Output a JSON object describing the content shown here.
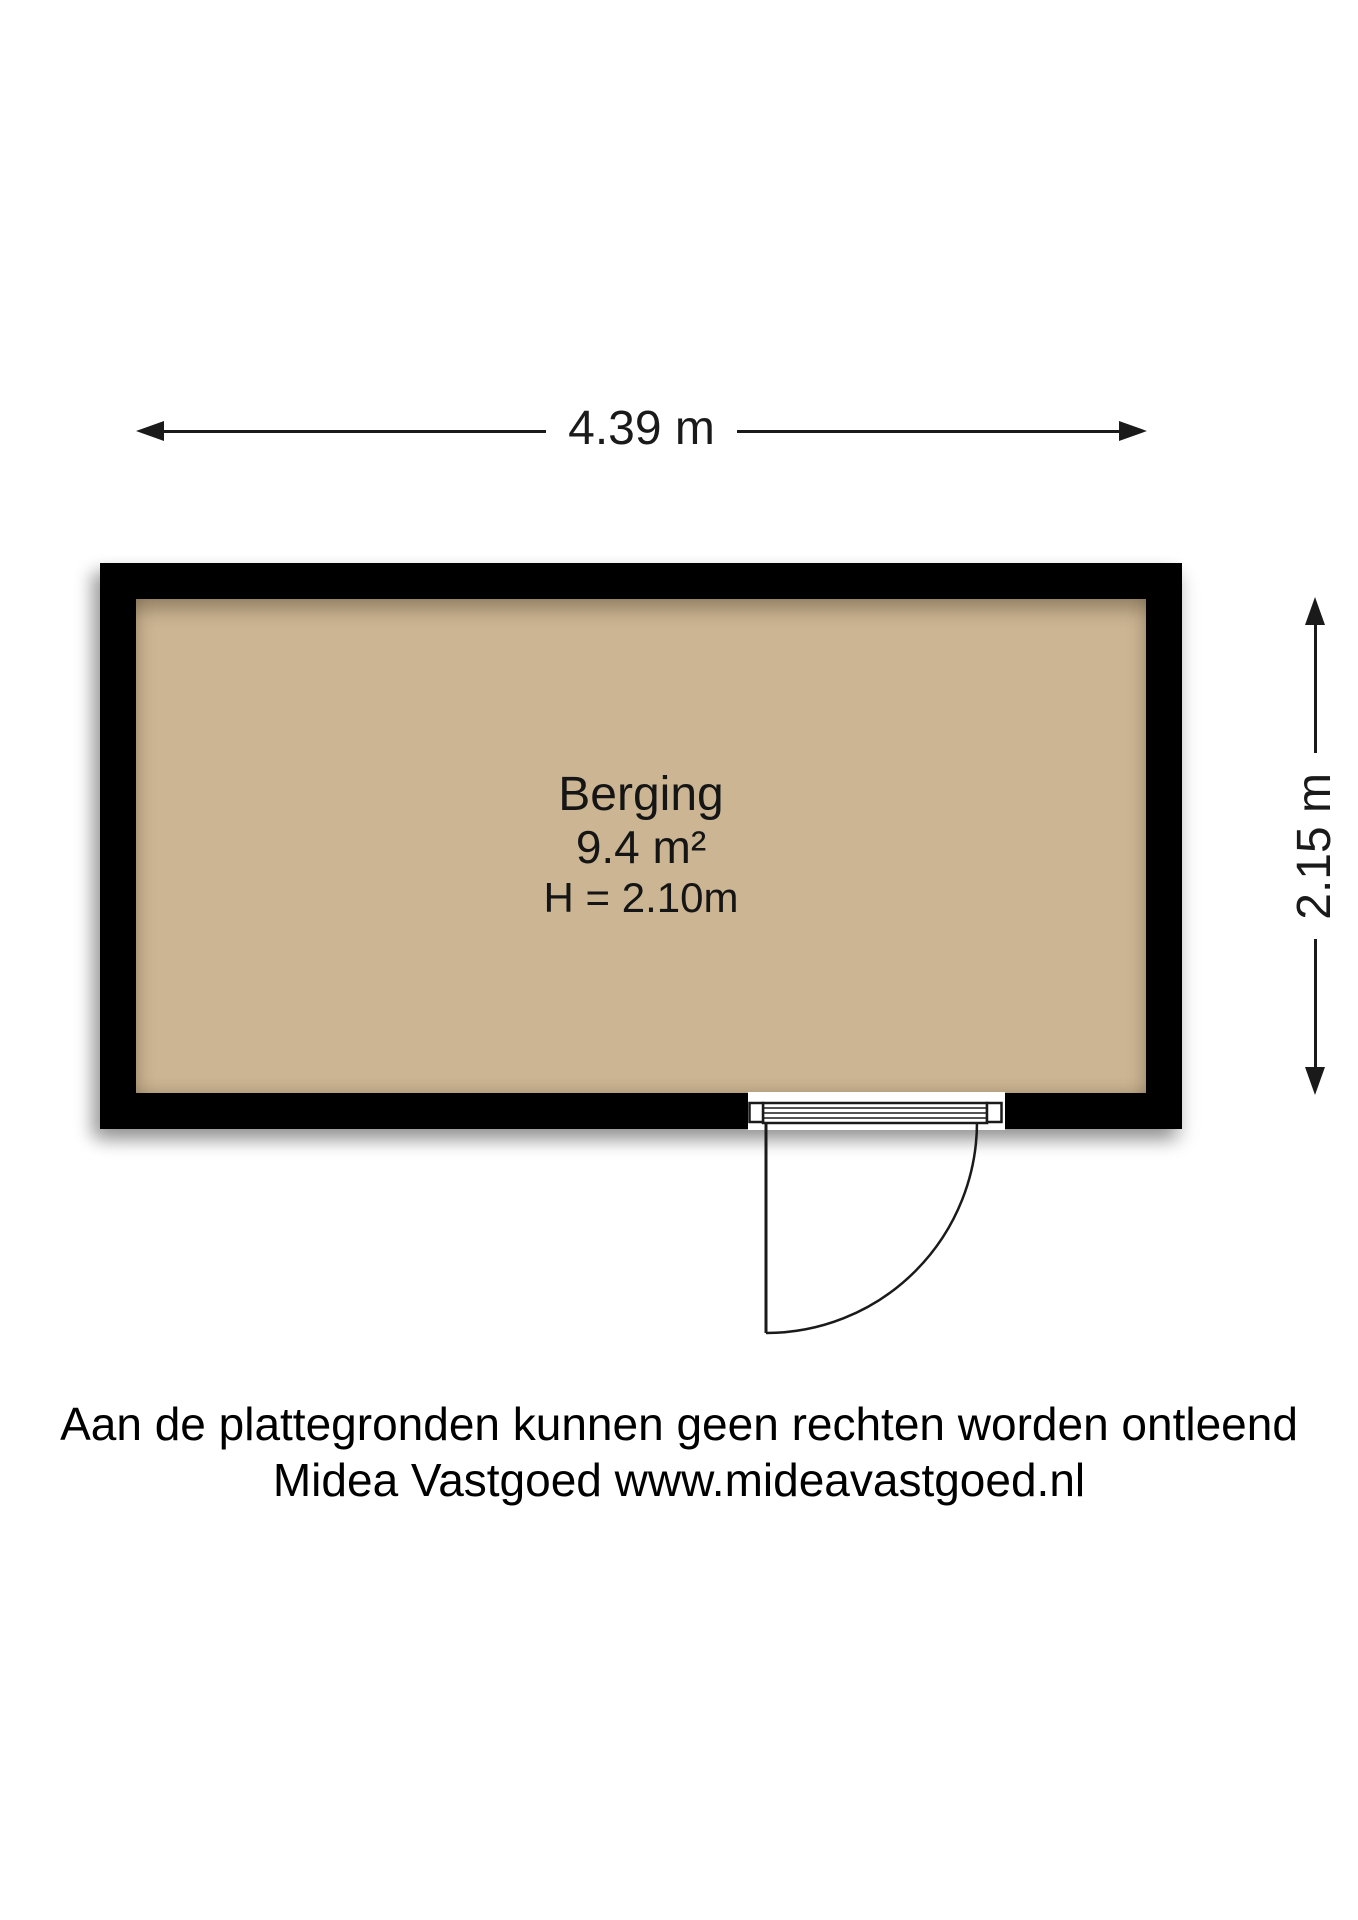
{
  "floorplan": {
    "dimensions": {
      "width_label": "4.39 m",
      "height_label": "2.15 m"
    },
    "room": {
      "name": "Berging",
      "area": "9.4 m²",
      "ceiling_height": "H = 2.10m"
    },
    "colors": {
      "wall": "#000000",
      "floor": "#cbb593",
      "line": "#1a1a1a"
    }
  },
  "footer": {
    "line1": "Aan de plattegronden kunnen geen rechten worden ontleend",
    "line2": "Midea Vastgoed www.mideavastgoed.nl"
  }
}
